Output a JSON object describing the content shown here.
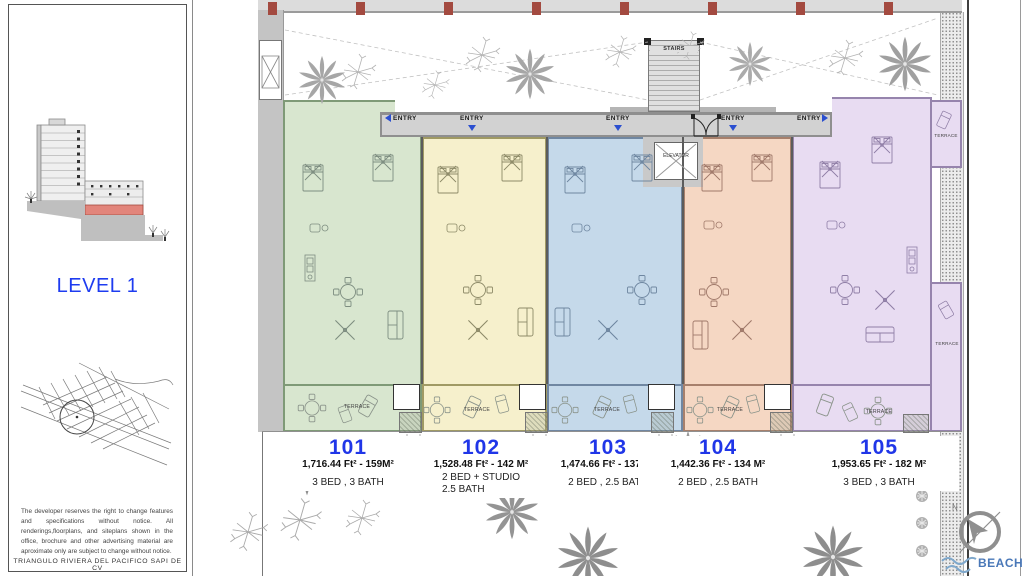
{
  "sidebar": {
    "level_title": "LEVEL 1",
    "disclaimer": "The developer reserves the right to change features and specifications without notice. All renderings,floorplans, and siteplans shown in the office, brochure and other advertising material are aproximate only are subject to change without notice.",
    "company": "TRIANGULO RIVIERA DEL PACIFICO SAPI DE CV",
    "section_icon": "building-section-elevation",
    "map_icon": "site-location-map"
  },
  "plan": {
    "stairs_label": "STAIRS",
    "elevator_label": "ELEVATOR",
    "terrace_label": "TERRACE",
    "entries": [
      {
        "label": "ENTRY",
        "arrow": "left"
      },
      {
        "label": "ENTRY",
        "arrow": "down"
      },
      {
        "label": "ENTRY",
        "arrow": "down"
      },
      {
        "label": "ENTRY",
        "arrow": "down"
      },
      {
        "label": "ENTRY",
        "arrow": "right"
      }
    ],
    "compass_north": "N",
    "beach_label": "BEACH",
    "colors": {
      "accent_blue": "#2036e8",
      "entry_arrow_blue": "#2b4fd0",
      "column_red": "#a34a40",
      "beach_blue": "#4a78b8",
      "corridor_gray": "#d2d2d2"
    },
    "icons": [
      "palm-tree-icon",
      "thin-tree-icon",
      "compass-icon",
      "beach-waves-icon",
      "double-door-icon",
      "elevator-x-icon"
    ]
  },
  "units": [
    {
      "number": "101",
      "area": "1,716.44 Ft² - 159M²",
      "beds": "3 BED , 3 BATH",
      "color": "#d8e6cf",
      "wall": "#7f9a77"
    },
    {
      "number": "102",
      "area": "1,528.48 Ft² - 142 M²",
      "beds": "2 BED + STUDIO",
      "beds2": "2.5 BATH",
      "color": "#f6f0cc",
      "wall": "#a09a64"
    },
    {
      "number": "103",
      "area": "1,474.66 Ft² - 137 M²",
      "beds": "2 BED , 2.5 BATH",
      "color": "#c5d9ea",
      "wall": "#7087a2"
    },
    {
      "number": "104",
      "area": "1,442.36 Ft² - 134 M²",
      "beds": "2 BED , 2.5 BATH",
      "color": "#f5d7c3",
      "wall": "#a7806c"
    },
    {
      "number": "105",
      "area": "1,953.65 Ft² - 182 M²",
      "beds": "3 BED , 3 BATH",
      "color": "#e8dcf2",
      "wall": "#9684ad"
    }
  ]
}
